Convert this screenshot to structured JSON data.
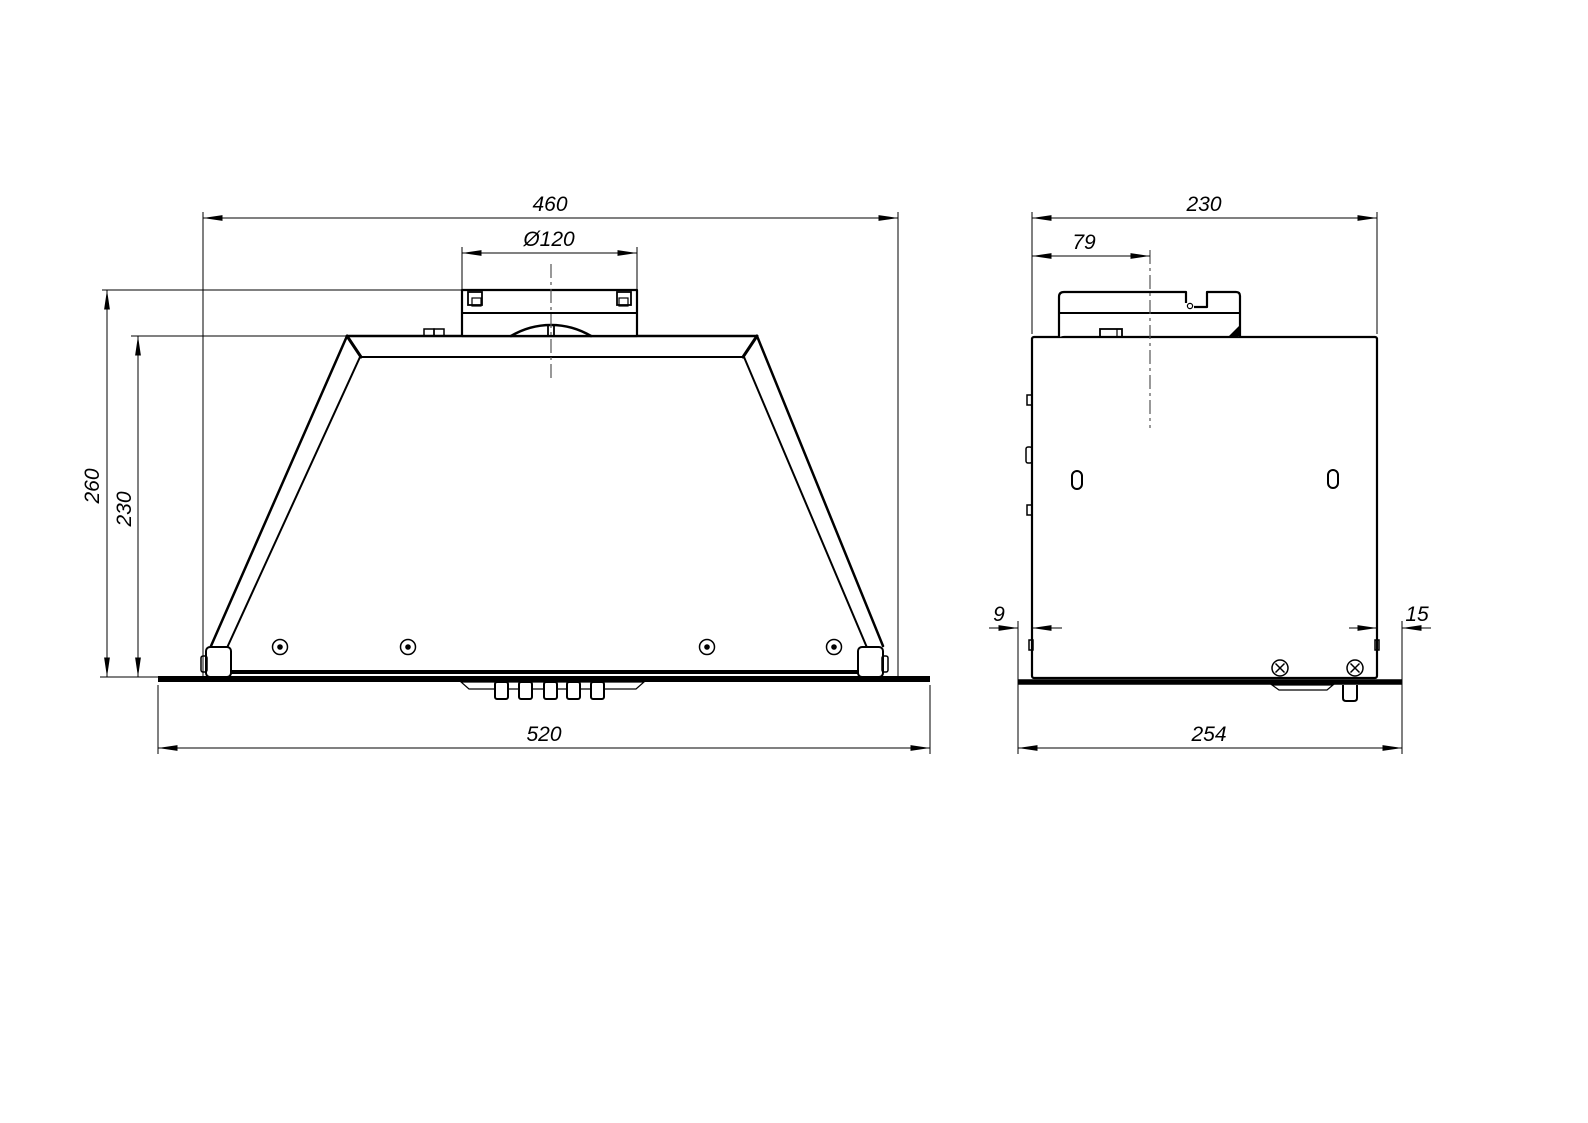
{
  "colors": {
    "line": "#000000",
    "background": "#ffffff",
    "centerline": "#555555"
  },
  "front_view": {
    "dims": {
      "body_width": "460",
      "duct_diameter": "Ø120",
      "total_height": "260",
      "body_height": "230",
      "panel_width": "520"
    }
  },
  "side_view": {
    "dims": {
      "body_depth": "230",
      "duct_center_offset": "79",
      "rear_overhang": "9",
      "front_overhang": "15",
      "panel_depth": "254"
    }
  }
}
